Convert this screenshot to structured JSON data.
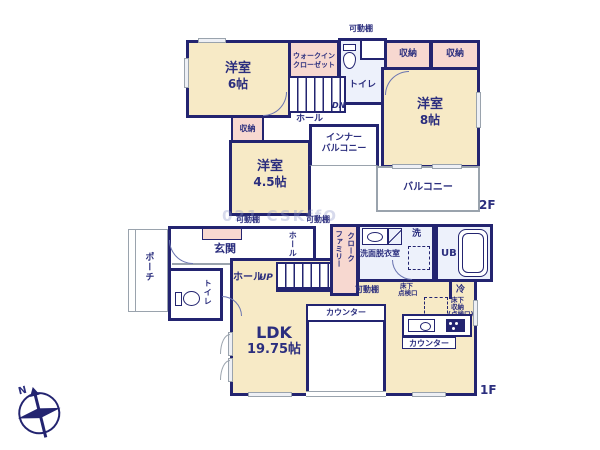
{
  "f2": {
    "floor_label": "2F",
    "room6_name": "洋室",
    "room6_size": "6帖",
    "wic_line1": "ウォークイン",
    "wic_line2": "クローゼット",
    "shelf": "可動棚",
    "toilet": "トイレ",
    "storage": "収納",
    "hall": "ホール",
    "dn": "DN",
    "room8_name": "洋室",
    "room8_size": "8帖",
    "room45_name": "洋室",
    "room45_size": "4.5帖",
    "inner_balcony_line1": "インナー",
    "inner_balcony_line2": "バルコニー",
    "balcony": "バルコニー"
  },
  "f1": {
    "floor_label": "1F",
    "porch": "ポーチ",
    "genkan": "玄関",
    "shelf": "可動棚",
    "toilet": "トイレ",
    "hall": "ホール",
    "hall_vertical": "ホール",
    "up": "UP",
    "family_closet_line1": "ファミリー",
    "family_closet_line2": "クローク",
    "washroom": "洗面脱衣室",
    "washer": "洗",
    "bath": "UB",
    "underfloor_access_line1": "床下",
    "underfloor_access_line2": "点検口",
    "fridge": "冷",
    "underfloor_storage_line1": "床下",
    "underfloor_storage_line2": "収納",
    "underfloor_storage_line3": "(点検口)",
    "counter": "カウンター",
    "kitchen_counter": "カウンター",
    "ldk_name": "LDK",
    "ldk_size": "19.75帖"
  },
  "compass": {
    "north": "N"
  },
  "watermark": {
    "text": "021 CSKffO"
  }
}
